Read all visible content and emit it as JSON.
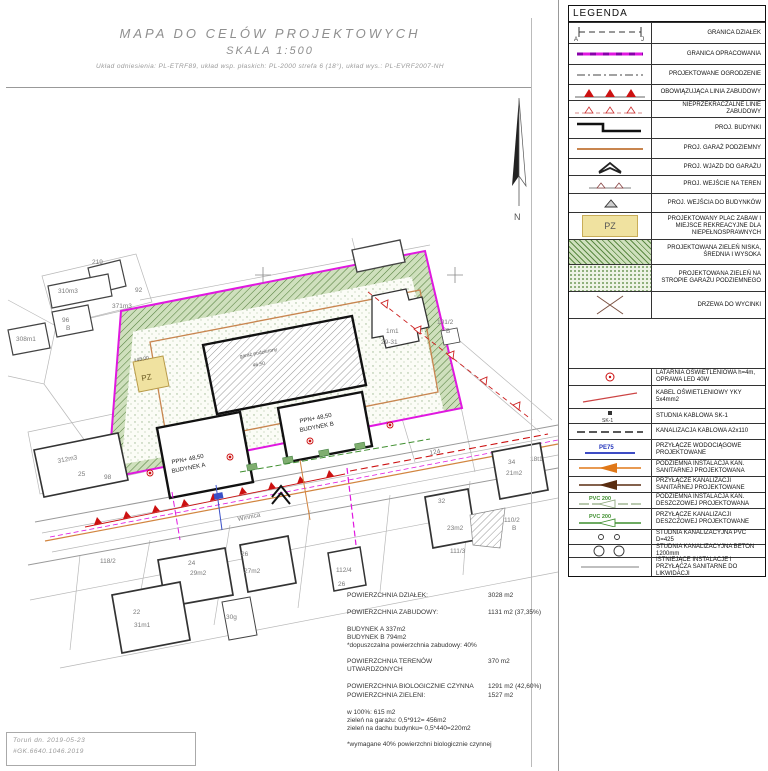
{
  "title_block": {
    "line1": "MAPA DO CELÓW PROJEKTOWYCH",
    "line2": "SKALA 1:500",
    "line3": "Układ odniesienia: PL-ETRF89, układ wsp. płaskich: PL-2000 strefa 6 (18°), układ wys.: PL-EVRF2007-NH"
  },
  "legend": {
    "header": "LEGENDA",
    "items": [
      {
        "label": "GRANICA DZIAŁEK",
        "sym_a": "A",
        "sym_j": "J"
      },
      {
        "label": "GRANICA OPRACOWANIA"
      },
      {
        "label": "PROJEKTOWANE OGRODZENIE"
      },
      {
        "label": "OBOWIĄZUJĄCA LINIA ZABUDOWY"
      },
      {
        "label": "NIEPRZEKRACZALNE LINIE ZABUDOWY"
      },
      {
        "label": "PROJ. BUDYNKI"
      },
      {
        "label": "PROJ. GARAŻ PODZIEMNY"
      },
      {
        "label": "PROJ. WJAZD DO GARAŻU"
      },
      {
        "label": "PROJ. WEJŚCIE NA TEREN"
      },
      {
        "label": "PROJ. WEJŚCIA DO BUDYNKÓW"
      },
      {
        "label": "PROJEKTOWANY PLAC ZABAW I MIEJSCE REKREACYJNE DLA NIEPEŁNOSPRAWNYCH",
        "sym_text": "PZ"
      },
      {
        "label": "PROJEKTOWANA ZIELEŃ NISKA, ŚREDNIA I WYSOKA"
      },
      {
        "label": "PROJEKTOWANA ZIELEŃ NA STROPIE GARAŻU PODZIEMNEGO"
      },
      {
        "label": "DRZEWA DO WYCINKI"
      },
      {
        "label": ""
      },
      {
        "label": "LATARNIA OŚWIETLENIOWA h=4m, OPRAWA LED 40W"
      },
      {
        "label": "KABEL OŚWIETLENIOWY YKY 5x4mm2"
      },
      {
        "label": "STUDNIA KABLOWA SK-1",
        "sym_text": "SK-1"
      },
      {
        "label": "KANALIZACJA KABLOWA A2x110"
      },
      {
        "label": "PRZYŁĄCZE WODOCIĄGOWE PROJEKTOWANE",
        "sym_text": "PE75"
      },
      {
        "label": "PODZIEMNA INSTALACJA KAN. SANITARNEJ PROJEKTOWANA"
      },
      {
        "label": "PRZYŁĄCZE KANALIZACJI SANITARNEJ PROJEKTOWANE"
      },
      {
        "label": "PODZIEMNA INSTALACJA KAN. DESZCZOWEJ PROJEKTOWANA",
        "sym_text": "PVC 200"
      },
      {
        "label": "PRZYŁĄCZE KANALIZACJI DESZCZOWEJ PROJEKTOWANE",
        "sym_text": "PVC 200"
      },
      {
        "label": "STUDNIA KANALIZACYJNA PVC D=425"
      },
      {
        "label": "STUDNIA KANALIZACYJNA BETON 1200mm"
      },
      {
        "label": "ISTNIEJĄCE INSTALACJE I PRZYŁĄCZA SANITARNE DO LIKWIDACJI"
      }
    ]
  },
  "stats": {
    "rows": [
      {
        "label": "POWIERZCHNIA DZIAŁEK:",
        "value": "3028 m2"
      },
      {
        "label": "POWIERZCHNIA ZABUDOWY:",
        "value": "1131 m2 (37,35%)"
      },
      {
        "label": "POWIERZCHNIA TERENÓW UTWARDZONYCH",
        "value": "370 m2"
      },
      {
        "label": "POWIERZCHNIA BIOLOGICZNIE CZYNNA",
        "value": "1291 m2 (42,60%)"
      },
      {
        "label": "POWIERZCHNIA ZIELENI:",
        "value": "1527 m2"
      }
    ],
    "building_lines": [
      "BUDYNEK A    337m2",
      "BUDYNEK B    794m2",
      "*dopuszczalna powierzchnia zabudowy: 40%"
    ],
    "green_lines": [
      "w 100%:  615 m2",
      "zieleń na garażu: 0,5*912= 456m2",
      "zieleń na dachu budynku= 0,5*440=220m2"
    ],
    "note": "*wymagane 40% powierzchni biologicznie czynnej"
  },
  "footer": {
    "line1": "Toruń dn. 2019-05-23",
    "line2": "#GK.6640.1046.2019"
  },
  "map": {
    "north_label": "N",
    "labels": [
      "219",
      "92",
      "310m3",
      "371m3",
      "96",
      "B",
      "308m1",
      "312m3",
      "25",
      "98",
      "101/2",
      "B",
      "1m1",
      "29-31",
      "124",
      "Winnica",
      "118/2",
      "24",
      "29m2",
      "26",
      "27m2",
      "22",
      "31m1",
      "30g",
      "112/4",
      "26",
      "34",
      "21m2",
      "32",
      "23m2",
      "110/2",
      "B",
      "111/3",
      "18t1",
      "PPN+ 48,50",
      "BUDYNEK A",
      "PPN+ 48,50",
      "BUDYNEK B",
      "garaż podziemny",
      "46,50",
      "PZ",
      "+48,00"
    ]
  },
  "colors": {
    "boundary_magenta": "#e018e0",
    "building_line_red": "#cc1111",
    "green_band": "#5c8a44",
    "playground_yellow": "#f0e2a0",
    "water_blue": "#2233bb",
    "sanitary_orange": "#e07818",
    "storm_green": "#3f8f2f",
    "garage_brown": "#c8854f"
  }
}
